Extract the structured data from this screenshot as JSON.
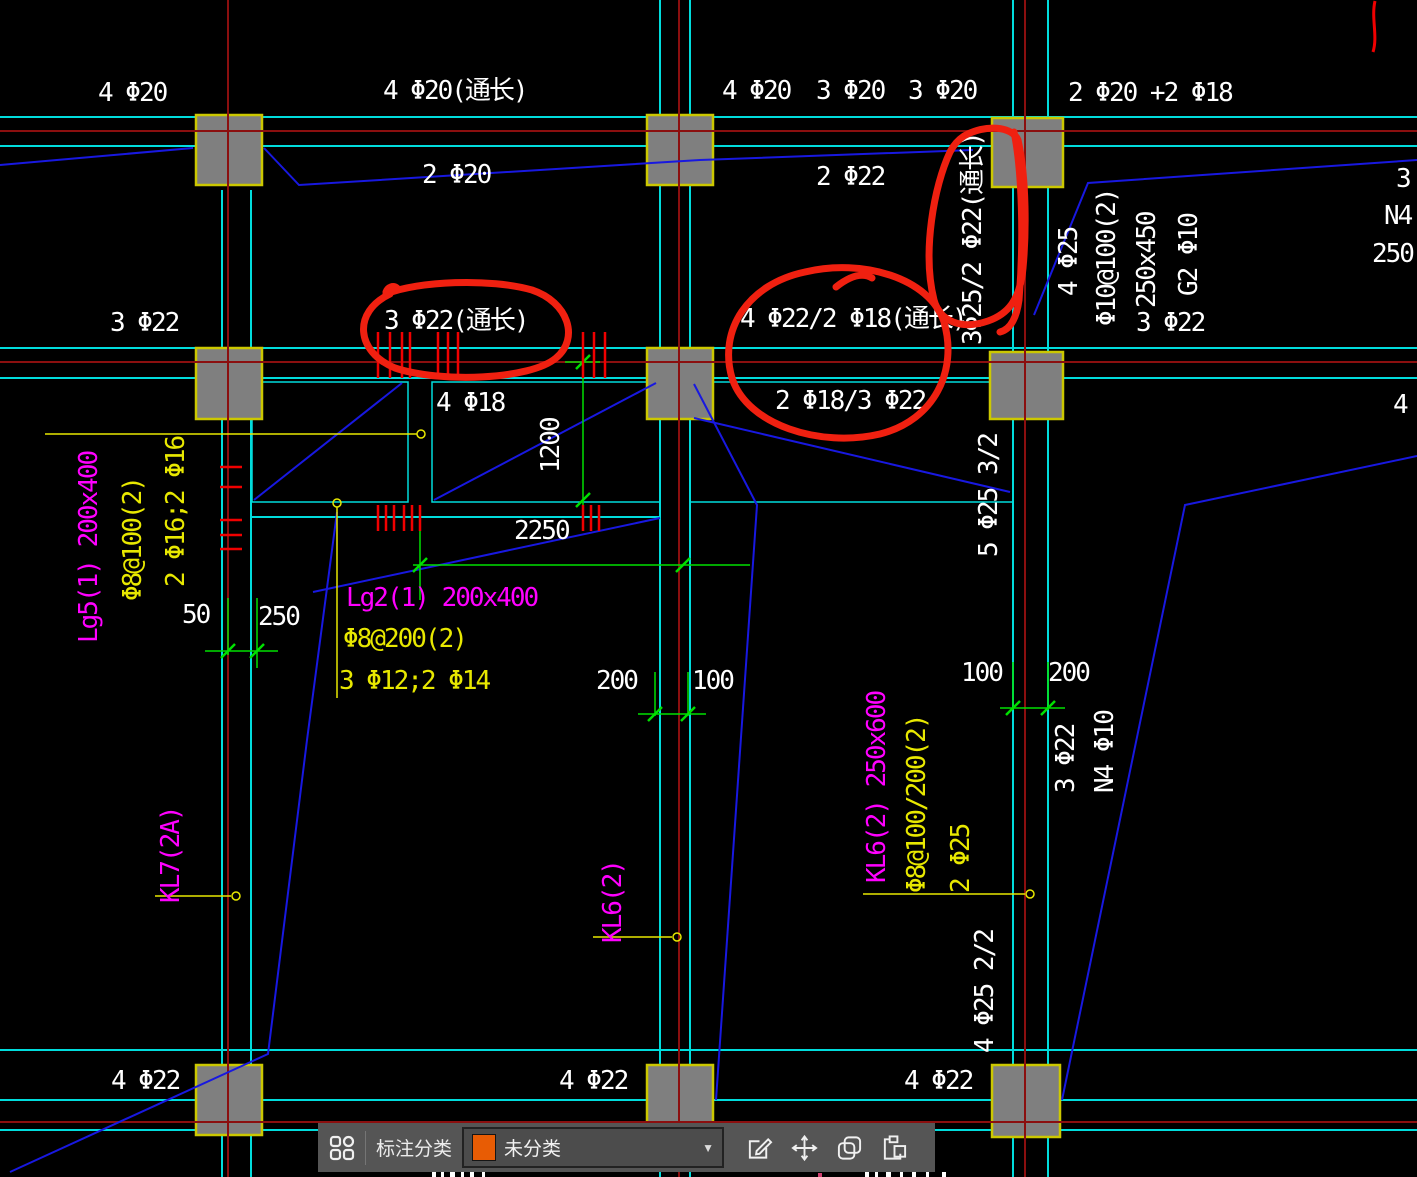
{
  "drawing": {
    "colors": {
      "background": "#000000",
      "beam_line": "#00dcdc",
      "grid_line": "#8b0f0f",
      "leader_line": "#1818e0",
      "dimension_line": "#00e000",
      "stirrup_tick": "#f00000",
      "text_rebar": "#ffffff",
      "text_beam_name": "#ff00ff",
      "text_stirrup": "#e8e800",
      "column_fill": "#7f7f7f",
      "column_border": "#ccc800",
      "red_markup": "#f02010"
    },
    "highlighted_by_red_markup": [
      "3 Φ22(通长)",
      "4 Φ22/2 Φ18(通长)",
      "3Φ25/2 Φ22(通长)"
    ],
    "labels": [
      {
        "text": "4 Φ20",
        "x": 98,
        "y": 80,
        "color": "#ffffff",
        "vertical": false,
        "kind": "rebar-spec"
      },
      {
        "text": "4 Φ20(通长)",
        "x": 383,
        "y": 78,
        "color": "#ffffff",
        "vertical": false,
        "kind": "rebar-spec"
      },
      {
        "text": "4 Φ20",
        "x": 722,
        "y": 78,
        "color": "#ffffff",
        "vertical": false,
        "kind": "rebar-spec"
      },
      {
        "text": "3 Φ20",
        "x": 816,
        "y": 78,
        "color": "#ffffff",
        "vertical": false,
        "kind": "rebar-spec"
      },
      {
        "text": "3 Φ20",
        "x": 908,
        "y": 78,
        "color": "#ffffff",
        "vertical": false,
        "kind": "rebar-spec"
      },
      {
        "text": "2 Φ20 +2 Φ18",
        "x": 1068,
        "y": 80,
        "color": "#ffffff",
        "vertical": false,
        "kind": "rebar-spec"
      },
      {
        "text": "2 Φ20",
        "x": 422,
        "y": 162,
        "color": "#ffffff",
        "vertical": false,
        "kind": "rebar-spec"
      },
      {
        "text": "2 Φ22",
        "x": 816,
        "y": 164,
        "color": "#ffffff",
        "vertical": false,
        "kind": "rebar-spec"
      },
      {
        "text": "3 Φ22",
        "x": 110,
        "y": 310,
        "color": "#ffffff",
        "vertical": false,
        "kind": "rebar-spec"
      },
      {
        "text": "3 Φ22(通长)",
        "x": 384,
        "y": 308,
        "color": "#ffffff",
        "vertical": false,
        "kind": "rebar-spec"
      },
      {
        "text": "4 Φ22/2 Φ18(通长)",
        "x": 740,
        "y": 306,
        "color": "#ffffff",
        "vertical": false,
        "kind": "rebar-spec"
      },
      {
        "text": "2 Φ18/3 Φ22",
        "x": 775,
        "y": 388,
        "color": "#ffffff",
        "vertical": false,
        "kind": "rebar-spec"
      },
      {
        "text": "4 Φ18",
        "x": 436,
        "y": 390,
        "color": "#ffffff",
        "vertical": false,
        "kind": "rebar-spec"
      },
      {
        "text": "3 Φ22",
        "x": 1136,
        "y": 310,
        "color": "#ffffff",
        "vertical": false,
        "kind": "rebar-spec"
      },
      {
        "text": "3",
        "x": 1396,
        "y": 166,
        "color": "#ffffff",
        "vertical": false,
        "kind": "partial"
      },
      {
        "text": "N4",
        "x": 1384,
        "y": 203,
        "color": "#ffffff",
        "vertical": false,
        "kind": "partial"
      },
      {
        "text": "250",
        "x": 1372,
        "y": 241,
        "color": "#ffffff",
        "vertical": false,
        "kind": "partial"
      },
      {
        "text": "4",
        "x": 1393,
        "y": 392,
        "color": "#ffffff",
        "vertical": false,
        "kind": "partial"
      },
      {
        "text": "2250",
        "x": 514,
        "y": 518,
        "color": "#ffffff",
        "vertical": false,
        "kind": "dimension"
      },
      {
        "text": "50",
        "x": 182,
        "y": 602,
        "color": "#ffffff",
        "vertical": false,
        "kind": "dimension"
      },
      {
        "text": "250",
        "x": 258,
        "y": 604,
        "color": "#ffffff",
        "vertical": false,
        "kind": "dimension"
      },
      {
        "text": "200",
        "x": 596,
        "y": 668,
        "color": "#ffffff",
        "vertical": false,
        "kind": "dimension"
      },
      {
        "text": "100",
        "x": 692,
        "y": 668,
        "color": "#ffffff",
        "vertical": false,
        "kind": "dimension"
      },
      {
        "text": "100",
        "x": 961,
        "y": 660,
        "color": "#ffffff",
        "vertical": false,
        "kind": "dimension"
      },
      {
        "text": "200",
        "x": 1048,
        "y": 660,
        "color": "#ffffff",
        "vertical": false,
        "kind": "dimension"
      },
      {
        "text": "4 Φ22",
        "x": 111,
        "y": 1068,
        "color": "#ffffff",
        "vertical": false,
        "kind": "rebar-spec"
      },
      {
        "text": "4 Φ22",
        "x": 559,
        "y": 1068,
        "color": "#ffffff",
        "vertical": false,
        "kind": "rebar-spec"
      },
      {
        "text": "4 Φ22",
        "x": 904,
        "y": 1068,
        "color": "#ffffff",
        "vertical": false,
        "kind": "rebar-spec"
      },
      {
        "text": "Lg2(1) 200x400",
        "x": 346,
        "y": 585,
        "color": "#ff00ff",
        "vertical": false,
        "kind": "beam-name"
      },
      {
        "text": "Φ8@200(2)",
        "x": 343,
        "y": 626,
        "color": "#e8e800",
        "vertical": false,
        "kind": "stirrup-spec"
      },
      {
        "text": "3 Φ12;2 Φ14",
        "x": 339,
        "y": 668,
        "color": "#e8e800",
        "vertical": false,
        "kind": "rebar-spec"
      },
      {
        "text": "3Φ25/2 Φ22(通长)",
        "x": 960,
        "y": 345,
        "color": "#ffffff",
        "vertical": true,
        "kind": "rebar-spec"
      },
      {
        "text": "4 Φ25",
        "x": 1056,
        "y": 296,
        "color": "#ffffff",
        "vertical": true,
        "kind": "rebar-spec"
      },
      {
        "text": "Φ10@100(2)",
        "x": 1094,
        "y": 326,
        "color": "#ffffff",
        "vertical": true,
        "kind": "stirrup-spec"
      },
      {
        "text": "250x450",
        "x": 1134,
        "y": 308,
        "color": "#ffffff",
        "vertical": true,
        "kind": "dimension"
      },
      {
        "text": "G2 Φ10",
        "x": 1176,
        "y": 296,
        "color": "#ffffff",
        "vertical": true,
        "kind": "rebar-spec"
      },
      {
        "text": "1200",
        "x": 538,
        "y": 473,
        "color": "#ffffff",
        "vertical": true,
        "kind": "dimension"
      },
      {
        "text": "5 Φ25 3/2",
        "x": 976,
        "y": 557,
        "color": "#ffffff",
        "vertical": true,
        "kind": "rebar-spec"
      },
      {
        "text": "3 Φ22",
        "x": 1053,
        "y": 793,
        "color": "#ffffff",
        "vertical": true,
        "kind": "rebar-spec"
      },
      {
        "text": "N4 Φ10",
        "x": 1092,
        "y": 793,
        "color": "#ffffff",
        "vertical": true,
        "kind": "rebar-spec"
      },
      {
        "text": "4 Φ25 2/2",
        "x": 972,
        "y": 1053,
        "color": "#ffffff",
        "vertical": true,
        "kind": "rebar-spec"
      },
      {
        "text": "Lg5(1) 200x400",
        "x": 76,
        "y": 643,
        "color": "#ff00ff",
        "vertical": true,
        "kind": "beam-name"
      },
      {
        "text": "Φ8@100(2)",
        "x": 120,
        "y": 601,
        "color": "#e8e800",
        "vertical": true,
        "kind": "stirrup-spec"
      },
      {
        "text": "2 Φ16;2 Φ16",
        "x": 163,
        "y": 587,
        "color": "#e8e800",
        "vertical": true,
        "kind": "rebar-spec"
      },
      {
        "text": "KL7(2A)",
        "x": 158,
        "y": 903,
        "color": "#ff00ff",
        "vertical": true,
        "kind": "beam-name"
      },
      {
        "text": "KL6(2)",
        "x": 600,
        "y": 943,
        "color": "#ff00ff",
        "vertical": true,
        "kind": "beam-name"
      },
      {
        "text": "KL6(2) 250x600",
        "x": 864,
        "y": 883,
        "color": "#ff00ff",
        "vertical": true,
        "kind": "beam-name"
      },
      {
        "text": "Φ8@100/200(2)",
        "x": 904,
        "y": 893,
        "color": "#e8e800",
        "vertical": true,
        "kind": "stirrup-spec"
      },
      {
        "text": "2 Φ25",
        "x": 948,
        "y": 893,
        "color": "#e8e800",
        "vertical": true,
        "kind": "rebar-spec"
      }
    ]
  },
  "toolbar": {
    "category_label": "标注分类",
    "selected_category": "未分类",
    "swatch_color": "#e85c04",
    "caret": "▼",
    "icons": [
      "apps-grid-icon",
      "edit-icon",
      "move-icon",
      "copy-icon",
      "paste-icon"
    ]
  }
}
